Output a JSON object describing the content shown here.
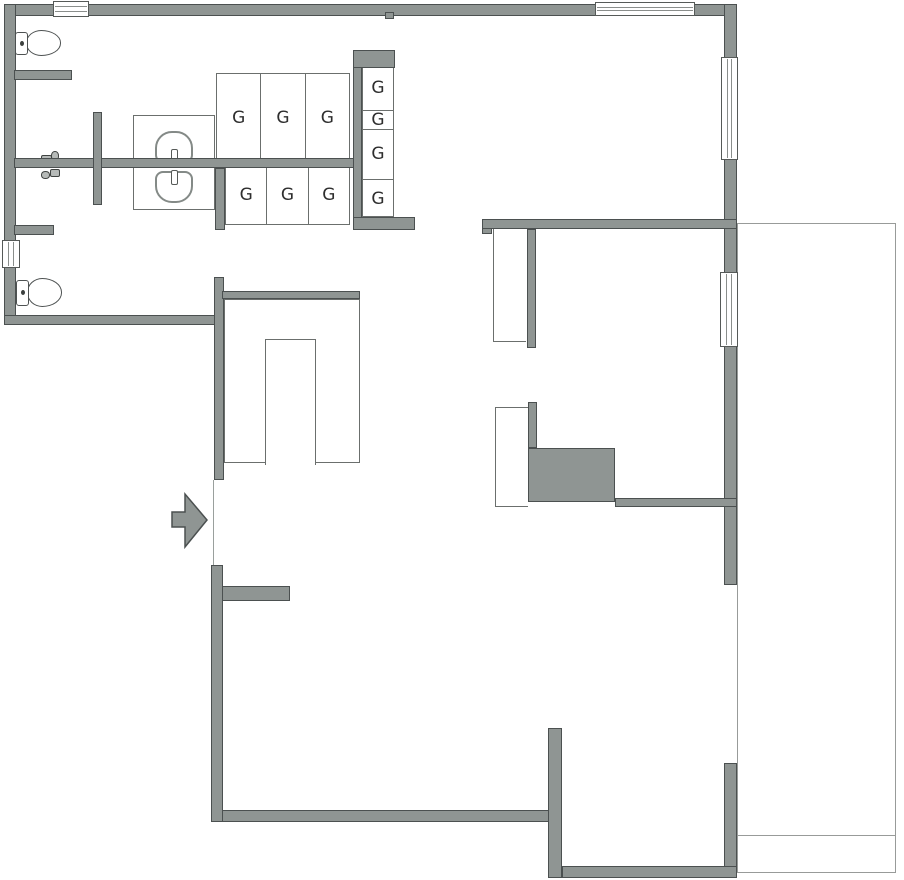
{
  "palette": {
    "bg": "#ffffff",
    "wall_fill": "#8f9593",
    "wall_edge": "#4b5050",
    "thin_line": "#6b6f6d",
    "annex_line": "#989b99",
    "fixture_line": "#4e5252",
    "basin_line": "#848a87",
    "label_color": "#2e2e2e"
  },
  "lockers": {
    "top_row": [
      "G",
      "G",
      "G"
    ],
    "bottom_row": [
      "G",
      "G",
      "G"
    ],
    "column": [
      "G",
      "G",
      "G",
      "G"
    ]
  },
  "icons": {
    "entrance": "arrow-right-icon",
    "toilet": "toilet-icon",
    "sink": "sink-basin-icon",
    "faucet": "faucet-icon",
    "window": "window-symbol"
  }
}
